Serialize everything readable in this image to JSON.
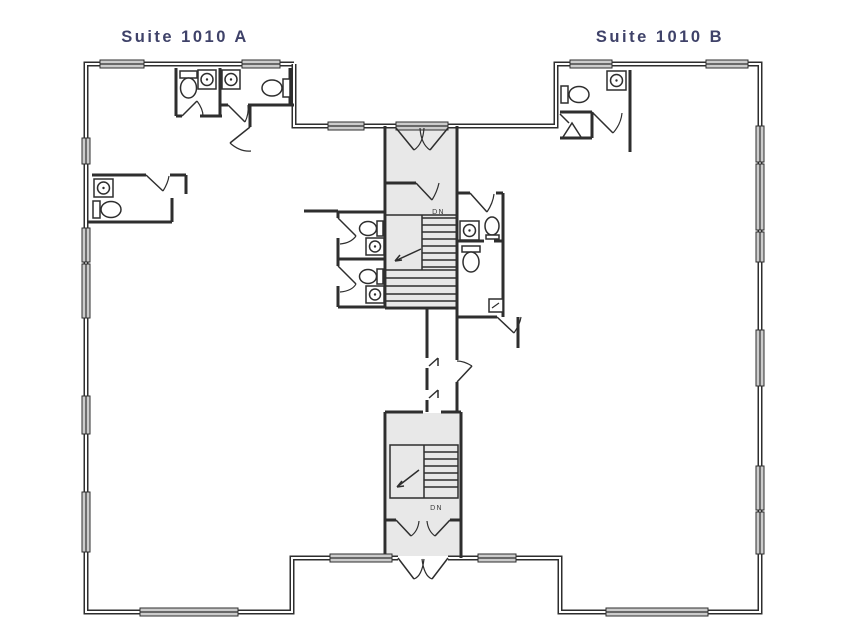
{
  "titles": {
    "suite_a": "Suite 1010 A",
    "suite_b": "Suite 1010 B"
  },
  "stair_labels": {
    "upper": "DN",
    "lower": "DN"
  },
  "colors": {
    "ink": "#2e2e2e",
    "title": "#3f4269",
    "shade": "#e8e8e8",
    "window_fill": "#cccccc",
    "label": "#4a4a4a",
    "background": "#ffffff"
  },
  "fixtures": {
    "toilets": 7,
    "sinks": 7,
    "lavatories": 1
  }
}
